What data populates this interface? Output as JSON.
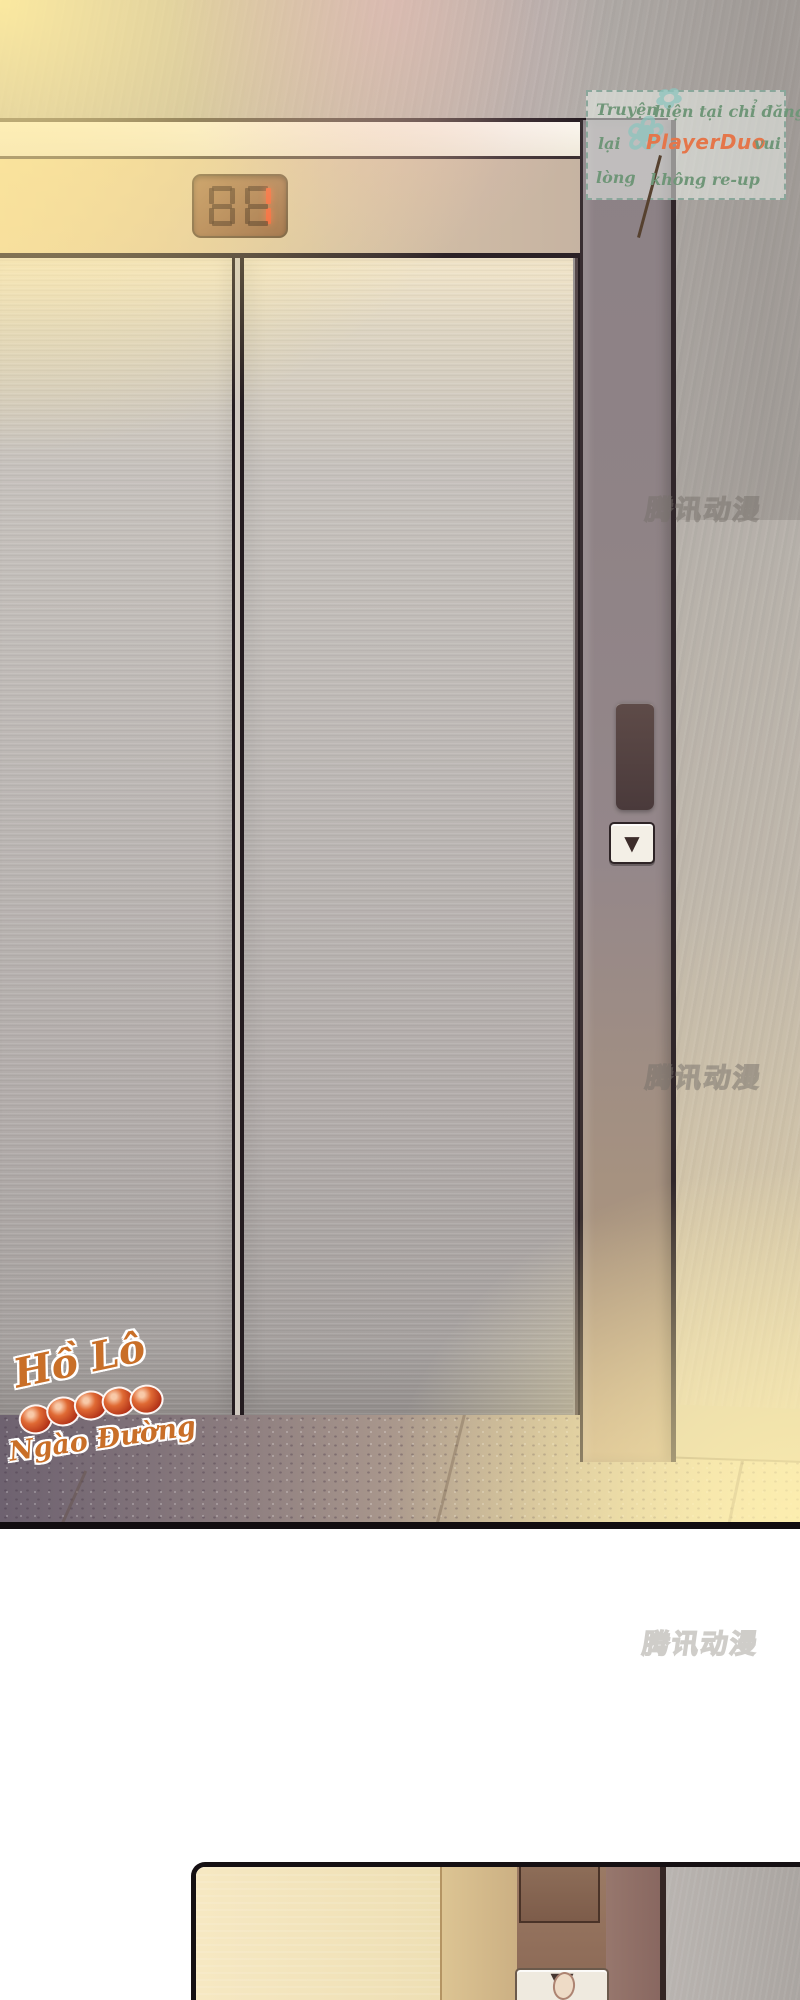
{
  "scene": {
    "panel1": "elevator hall with closed metal doors, lit by warm light",
    "panel2": "close-up of hand pressing elevator call button (cut off at page bottom)"
  },
  "credit_box": {
    "row1_left": "Truyện",
    "row1_right": "hiện tại chỉ đăng",
    "row2_left": "lại",
    "row2_brand": "PlayerDuo",
    "row2_right": "vui",
    "row3_left": "lòng",
    "row3_right": "không re-up",
    "text_color": "#6f9678",
    "brand_color": "#e5764a",
    "border_color": "#8aa79b"
  },
  "watermark": {
    "text": "腾讯动漫"
  },
  "artist_logo": {
    "line1": "Hồ Lô",
    "line2": "Ngào Đường",
    "color": "#c96f28"
  },
  "elevator": {
    "floor_display": {
      "ghost_digits": "88",
      "lit_value": "1",
      "lit_color": "#f04a28"
    },
    "call_panel": {
      "down_icon": "▼"
    }
  },
  "panel2": {
    "button_icon": "▼"
  },
  "colors": {
    "door_metal": "#bcb7b4",
    "pillar": "#8f8386",
    "glow_warm": "#ffec9f",
    "floor_dark": "#6e6270",
    "floor_light": "#f0e2b0",
    "panel_border": "#151013"
  }
}
